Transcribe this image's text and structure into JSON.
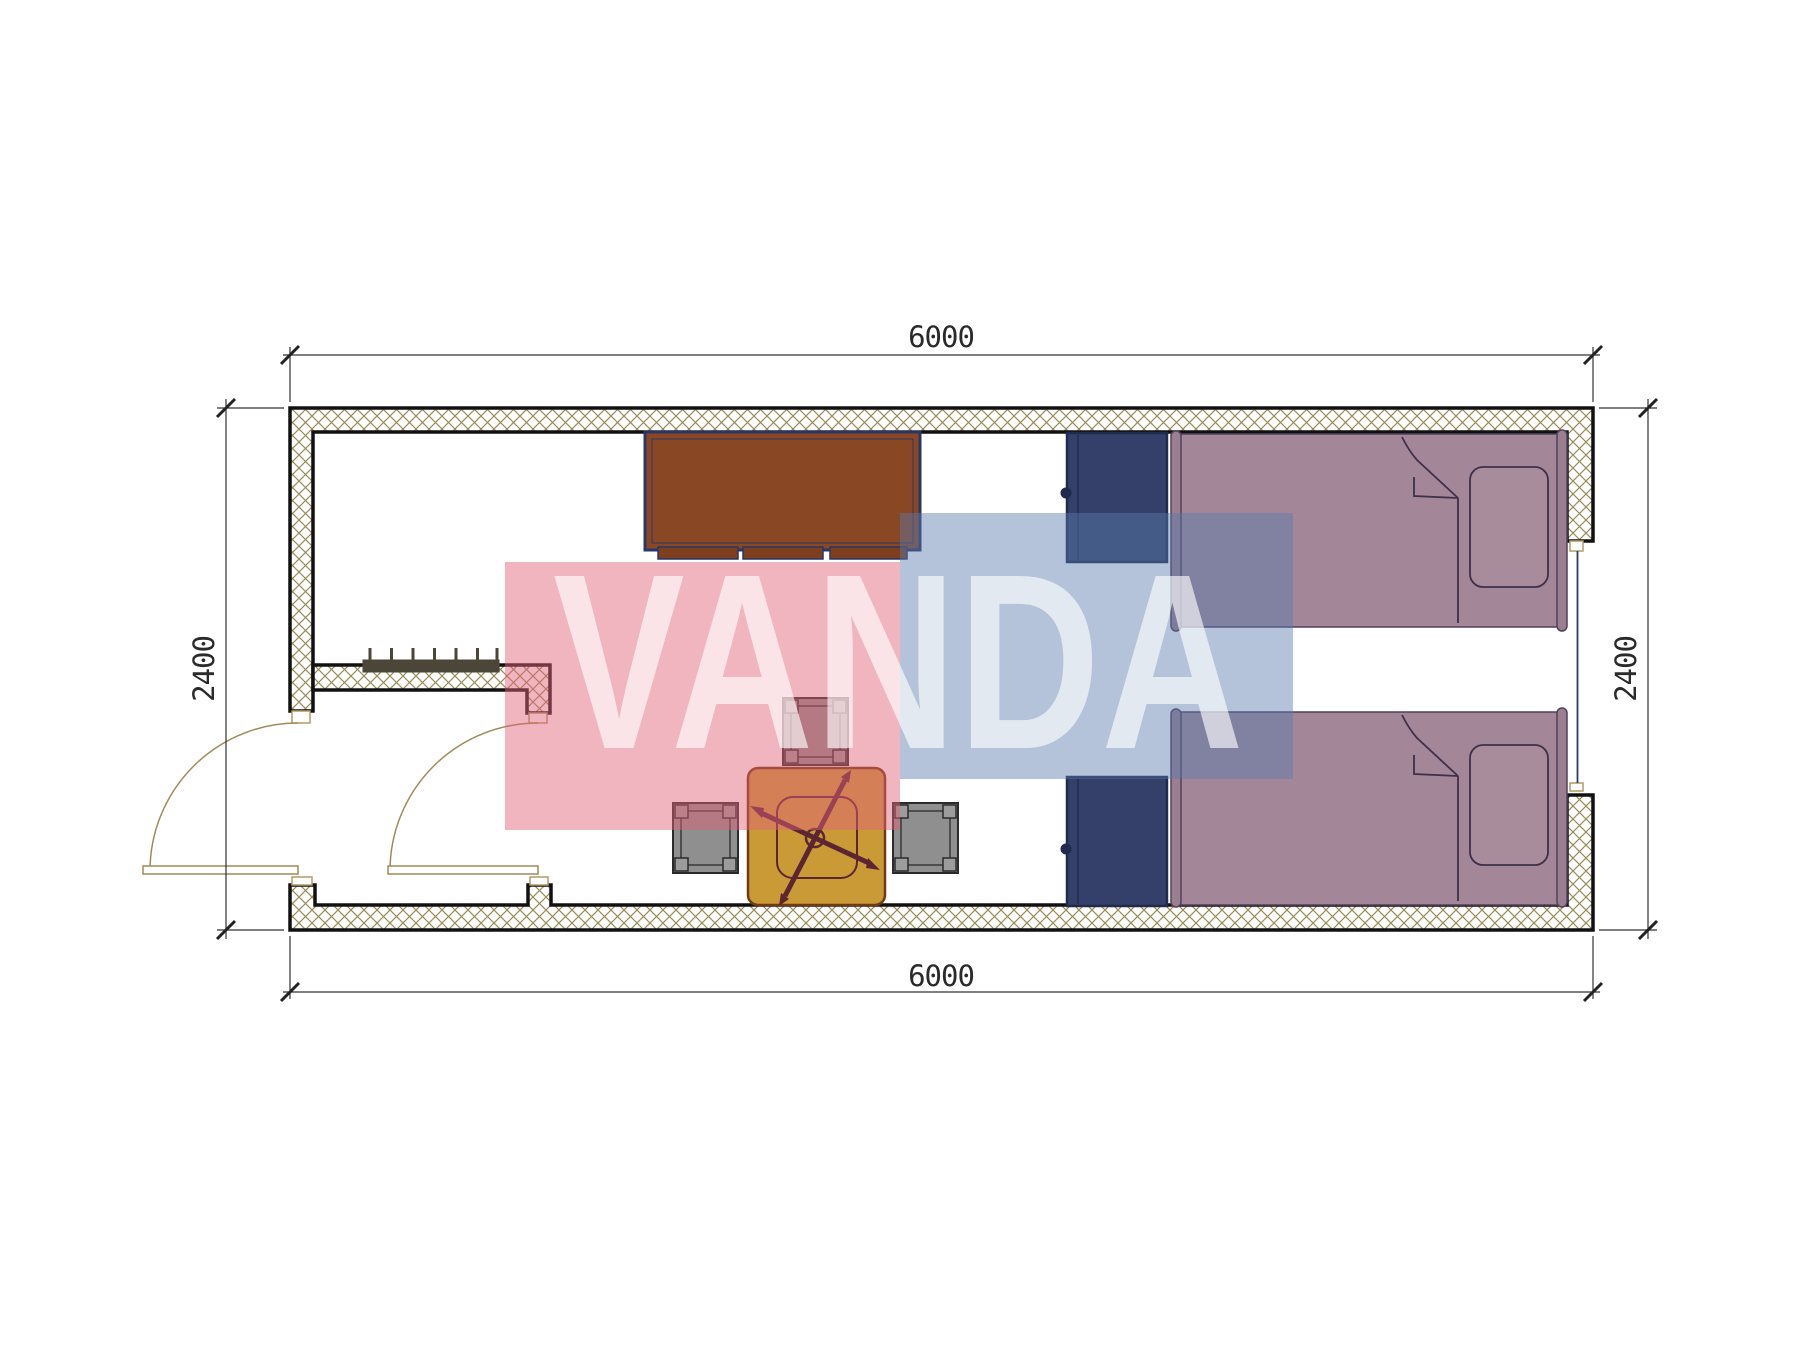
{
  "page": {
    "type": "architectural-floor-plan",
    "sheet_background": "#ffffff"
  },
  "dimensions": {
    "top": "6000",
    "bottom": "6000",
    "left": "2400",
    "right": "2400"
  },
  "watermark": {
    "text": "VANDA",
    "pink_color": "#e2627a",
    "blue_color": "#587aac",
    "letter_color": "#ffffff"
  },
  "plan": {
    "wall_hatch_color": "#9b8b59",
    "wall_line_color": "#111111",
    "door_line_color": "#a08a58",
    "window_line_color": "#2c3a70",
    "symbols": [
      {
        "name": "wardrobe-cabinet",
        "color": "#8a4723"
      },
      {
        "name": "nightstand",
        "color": "#344069"
      },
      {
        "name": "single-bed",
        "color": "#a38798"
      },
      {
        "name": "pillow",
        "color": "#a88c9b"
      },
      {
        "name": "square-table",
        "color": "#c99a35"
      },
      {
        "name": "office-chair",
        "color": "#5c2531"
      },
      {
        "name": "stool",
        "color": "#8f8f8f"
      },
      {
        "name": "radiator",
        "color": "#4b4637"
      },
      {
        "name": "entry-door-swing",
        "color": "#a08a58"
      },
      {
        "name": "interior-door-swing",
        "color": "#a08a58"
      },
      {
        "name": "window",
        "color": "#2c3a70"
      }
    ]
  }
}
